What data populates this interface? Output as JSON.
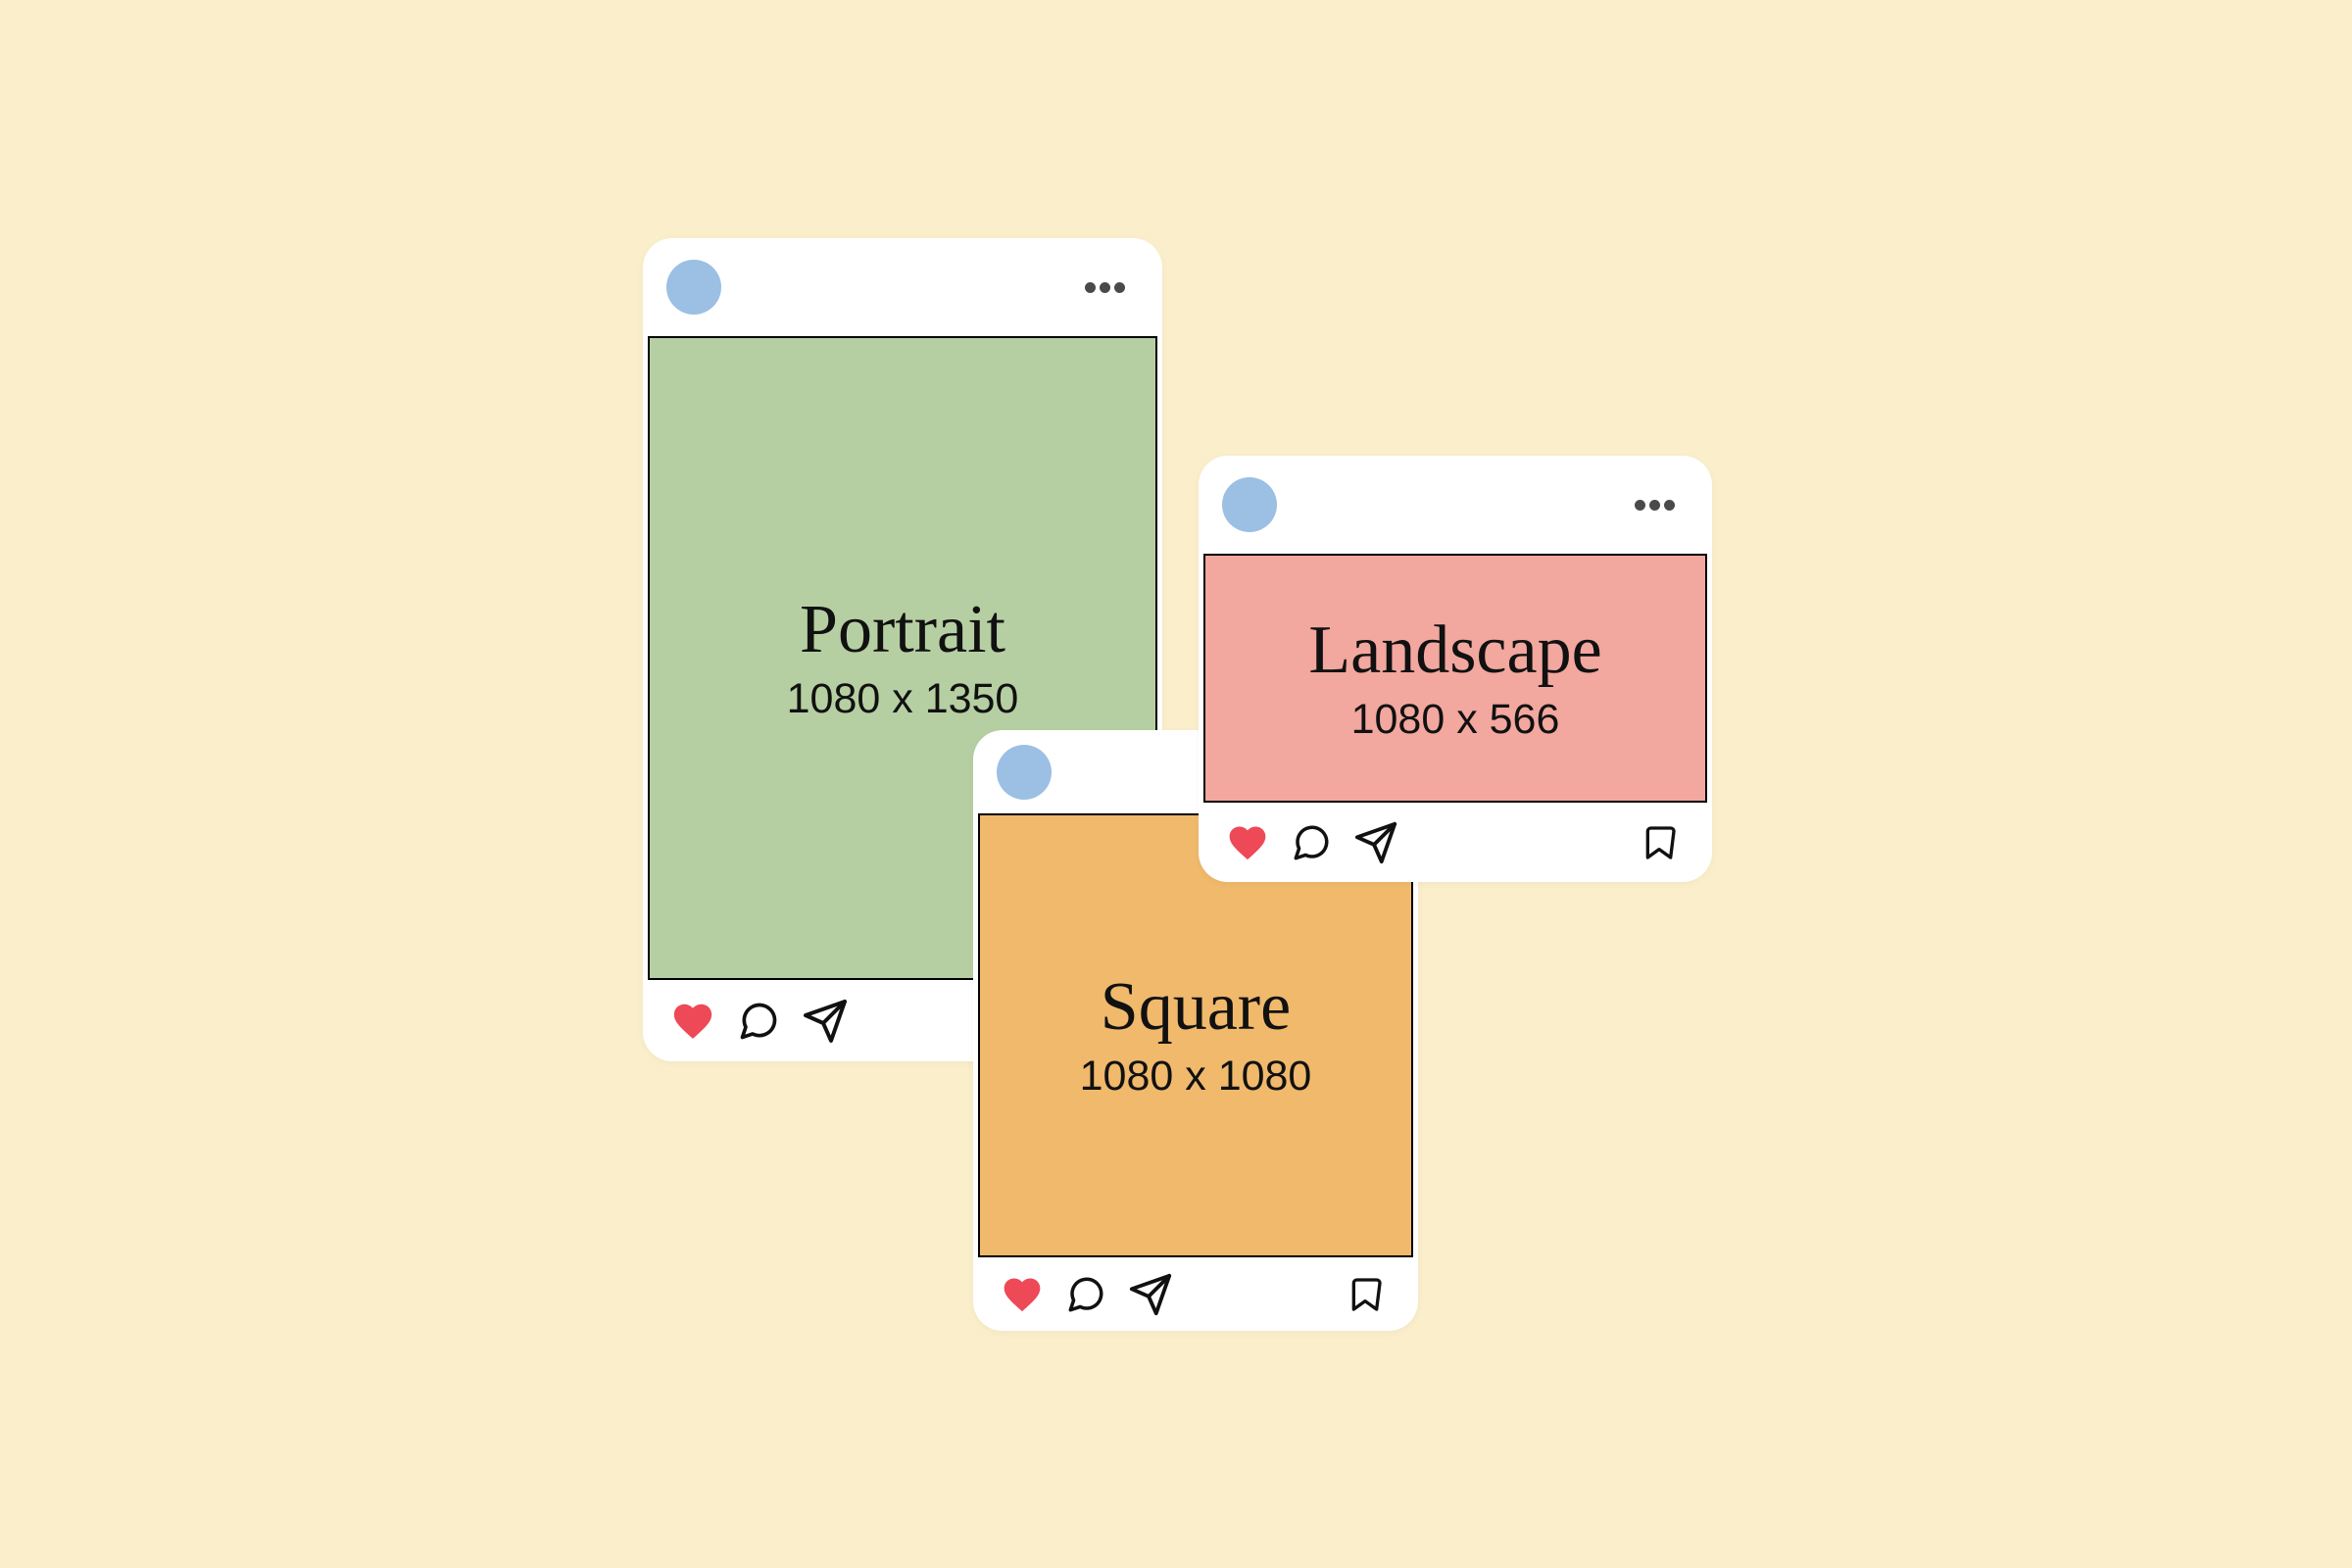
{
  "theme": {
    "background": "#FBEECB",
    "card_bg": "#FFFFFF",
    "avatar_blue": "#9CBFE4",
    "dots_gray": "#4A4A4A",
    "heart_red": "#ED4956",
    "icon_stroke": "#111111",
    "text_color": "#111111",
    "image_border": "#000000"
  },
  "cards": [
    {
      "name": "portrait-post",
      "title": "Portrait",
      "dimensions_label": "1080 x 1350",
      "image_color": "#B6CFA2",
      "header_icons": [
        "avatar",
        "more-options-icon"
      ],
      "action_icons": [
        "heart-icon",
        "comment-icon",
        "send-icon",
        "bookmark-icon"
      ]
    },
    {
      "name": "landscape-post",
      "title": "Landscape",
      "dimensions_label": "1080 x 566",
      "image_color": "#F2A79F",
      "header_icons": [
        "avatar",
        "more-options-icon"
      ],
      "action_icons": [
        "heart-icon",
        "comment-icon",
        "send-icon",
        "bookmark-icon"
      ]
    },
    {
      "name": "square-post",
      "title": "Square",
      "dimensions_label": "1080 x 1080",
      "image_color": "#F0B96C",
      "header_icons": [
        "avatar",
        "more-options-icon"
      ],
      "action_icons": [
        "heart-icon",
        "comment-icon",
        "send-icon",
        "bookmark-icon"
      ]
    }
  ]
}
